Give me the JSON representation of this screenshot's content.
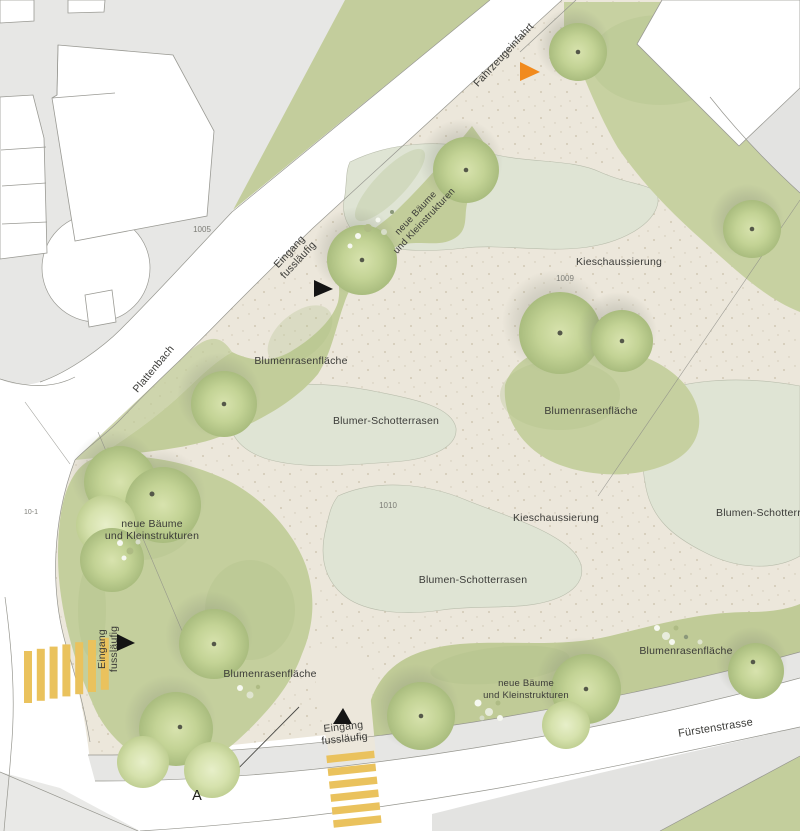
{
  "plan": {
    "streets": {
      "plattenbach": "Plattenbach",
      "fuerstenstrasse": "Fürstenstrasse",
      "fahrzeugeinfahrt": "Fahrzeugeinfahrt"
    },
    "entrance": {
      "line1": "Eingang",
      "line2": "fussläufig"
    },
    "areas": {
      "kieschaussierung": "Kieschaussierung",
      "blumenrasenflaeche": "Blumenrasenfläche",
      "blumen_schotterrasen": "Blumen-Schotterrasen",
      "blumer_schotterrasen": "Blumer-Schotterrasen",
      "neue_baeume_line1": "neue Bäume",
      "neue_baeume_line2": "und Kleinstrukturen"
    },
    "parcels": {
      "p1005": "1005",
      "p1009": "1009",
      "p1010": "1010",
      "p10_1": "10-1"
    },
    "section_marker": "A",
    "colors": {
      "grass": "#c5cf9e",
      "gravel": "#ece7db",
      "sage": "#dfe4d4",
      "pavement": "#e6e6e4",
      "road": "#ffffff",
      "crosswalk_yellow": "#eac25d",
      "marker_orange": "#f18a1d",
      "marker_black": "#141414",
      "label_text": "#3b3b38"
    }
  }
}
